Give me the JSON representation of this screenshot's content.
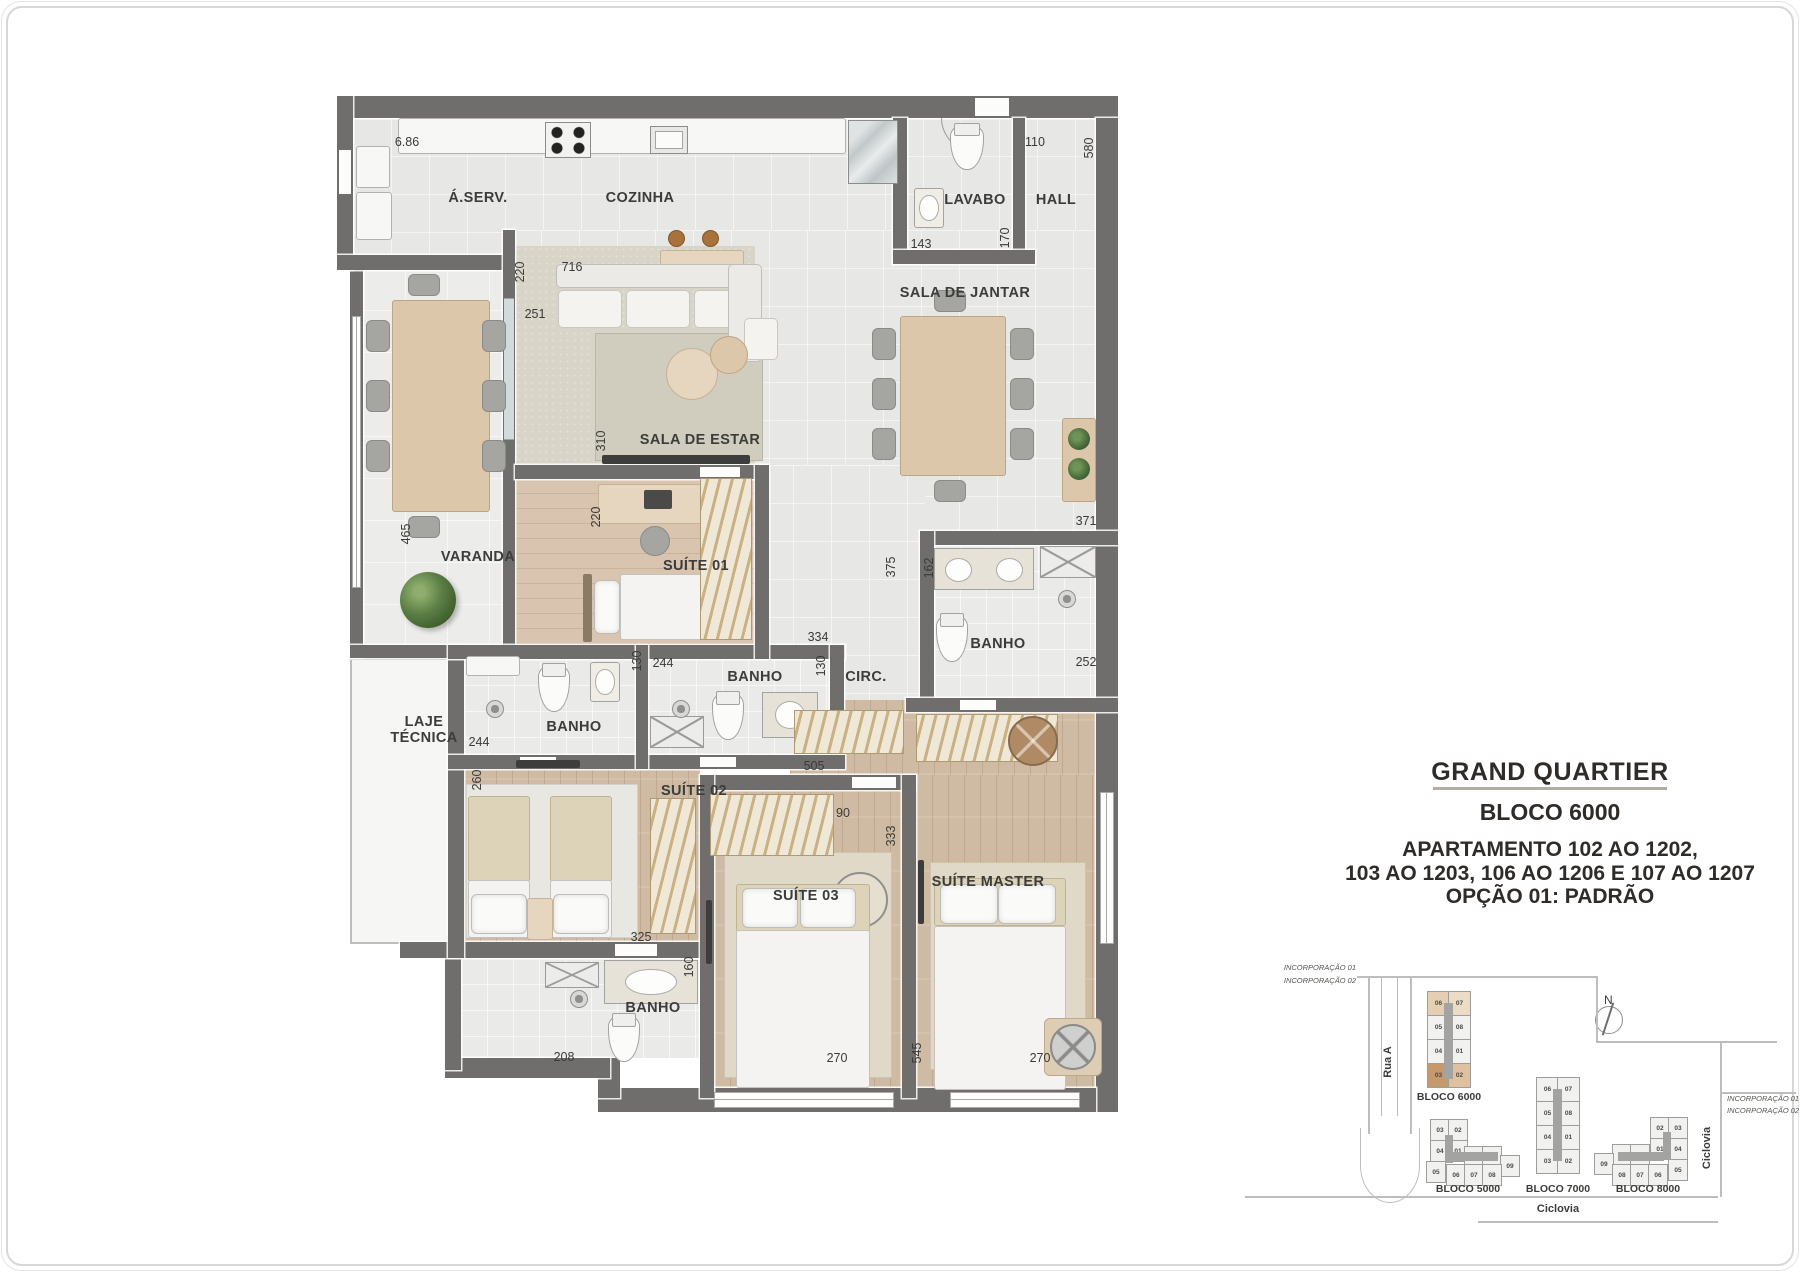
{
  "title_block": {
    "project": "GRAND QUARTIER",
    "block": "BLOCO 6000",
    "apartments_line1": "APARTAMENTO 102 AO 1202,",
    "apartments_line2": "103 AO 1203, 106 AO 1206 E 107 AO 1207",
    "apartments_line3": "OPÇÃO 01: PADRÃO"
  },
  "plan": {
    "room_labels": [
      {
        "id": "aserv",
        "text": "Á.SERV.",
        "x": 478,
        "y": 198
      },
      {
        "id": "cozinha",
        "text": "COZINHA",
        "x": 640,
        "y": 198
      },
      {
        "id": "lavabo",
        "text": "LAVABO",
        "x": 975,
        "y": 200
      },
      {
        "id": "hall",
        "text": "HALL",
        "x": 1056,
        "y": 200
      },
      {
        "id": "sala-de-jantar",
        "text": "SALA DE JANTAR",
        "x": 965,
        "y": 293
      },
      {
        "id": "sala-de-estar",
        "text": "SALA DE ESTAR",
        "x": 700,
        "y": 440
      },
      {
        "id": "varanda",
        "text": "VARANDA",
        "x": 478,
        "y": 557
      },
      {
        "id": "suite-01",
        "text": "SUÍTE 01",
        "x": 696,
        "y": 566
      },
      {
        "id": "laje-tecnica-1",
        "text": "LAJE",
        "x": 424,
        "y": 722
      },
      {
        "id": "laje-tecnica-2",
        "text": "TÉCNICA",
        "x": 424,
        "y": 738
      },
      {
        "id": "banho-suite02",
        "text": "BANHO",
        "x": 574,
        "y": 727
      },
      {
        "id": "banho-suite01",
        "text": "BANHO",
        "x": 755,
        "y": 677
      },
      {
        "id": "circ",
        "text": "CIRC.",
        "x": 866,
        "y": 677
      },
      {
        "id": "banho-master",
        "text": "BANHO",
        "x": 998,
        "y": 644
      },
      {
        "id": "suite-02",
        "text": "SUÍTE 02",
        "x": 694,
        "y": 791
      },
      {
        "id": "banho-inferior",
        "text": "BANHO",
        "x": 653,
        "y": 1008
      },
      {
        "id": "suite-03",
        "text": "SUÍTE 03",
        "x": 806,
        "y": 896
      },
      {
        "id": "suite-master",
        "text": "SUÍTE MASTER",
        "x": 988,
        "y": 882
      }
    ],
    "dimensions": [
      {
        "text": "6.86",
        "x": 407,
        "y": 142,
        "v": false
      },
      {
        "text": "220",
        "x": 520,
        "y": 272,
        "v": true
      },
      {
        "text": "716",
        "x": 572,
        "y": 267,
        "v": false
      },
      {
        "text": "251",
        "x": 535,
        "y": 314,
        "v": false
      },
      {
        "text": "110",
        "x": 1035,
        "y": 142,
        "v": false
      },
      {
        "text": "580",
        "x": 1089,
        "y": 148,
        "v": true
      },
      {
        "text": "143",
        "x": 921,
        "y": 244,
        "v": false
      },
      {
        "text": "170",
        "x": 1005,
        "y": 238,
        "v": true
      },
      {
        "text": "310",
        "x": 601,
        "y": 441,
        "v": true
      },
      {
        "text": "220",
        "x": 596,
        "y": 517,
        "v": true
      },
      {
        "text": "465",
        "x": 406,
        "y": 534,
        "v": true
      },
      {
        "text": "334",
        "x": 818,
        "y": 637,
        "v": false
      },
      {
        "text": "375",
        "x": 891,
        "y": 567,
        "v": true
      },
      {
        "text": "162",
        "x": 929,
        "y": 568,
        "v": true
      },
      {
        "text": "371",
        "x": 1086,
        "y": 521,
        "v": false
      },
      {
        "text": "252",
        "x": 1086,
        "y": 662,
        "v": false
      },
      {
        "text": "244",
        "x": 663,
        "y": 663,
        "v": false
      },
      {
        "text": "130",
        "x": 821,
        "y": 666,
        "v": true
      },
      {
        "text": "244",
        "x": 479,
        "y": 742,
        "v": false
      },
      {
        "text": "130",
        "x": 637,
        "y": 661,
        "v": true
      },
      {
        "text": "505",
        "x": 814,
        "y": 766,
        "v": false
      },
      {
        "text": "90",
        "x": 843,
        "y": 813,
        "v": false
      },
      {
        "text": "260",
        "x": 477,
        "y": 780,
        "v": true
      },
      {
        "text": "325",
        "x": 641,
        "y": 937,
        "v": false
      },
      {
        "text": "160",
        "x": 689,
        "y": 967,
        "v": true
      },
      {
        "text": "208",
        "x": 564,
        "y": 1057,
        "v": false
      },
      {
        "text": "333",
        "x": 891,
        "y": 836,
        "v": true
      },
      {
        "text": "270",
        "x": 837,
        "y": 1058,
        "v": false
      },
      {
        "text": "545",
        "x": 917,
        "y": 1053,
        "v": true
      },
      {
        "text": "270",
        "x": 1040,
        "y": 1058,
        "v": false
      }
    ]
  },
  "sitemap": {
    "north_label": "N",
    "streets": {
      "rua_a": "Rua A",
      "ciclovia_bottom": "Ciclovia",
      "ciclovia_right": "Ciclovia"
    },
    "incorporation_left": [
      "INCORPORAÇÃO 01",
      "INCORPORAÇÃO 02"
    ],
    "incorporation_right": [
      "INCORPORAÇÃO 01",
      "INCORPORAÇÃO 02"
    ],
    "buildings": [
      {
        "id": "bloco-6000",
        "label": "BLOCO 6000",
        "lx": 1449,
        "ly": 1097,
        "cw": 21,
        "ch": 23,
        "units": [
          {
            "n": "06",
            "x": 1427,
            "y": 991,
            "c": "#e5cfb3"
          },
          {
            "n": "07",
            "x": 1448,
            "y": 991,
            "c": "#ecdcc6"
          },
          {
            "n": "05",
            "x": 1427,
            "y": 1015
          },
          {
            "n": "08",
            "x": 1448,
            "y": 1015
          },
          {
            "n": "04",
            "x": 1427,
            "y": 1039
          },
          {
            "n": "01",
            "x": 1448,
            "y": 1039
          },
          {
            "n": "03",
            "x": 1427,
            "y": 1063,
            "c": "#c6996d"
          },
          {
            "n": "02",
            "x": 1448,
            "y": 1063,
            "c": "#dfc19f"
          }
        ]
      },
      {
        "id": "bloco-7000",
        "label": "BLOCO 7000",
        "lx": 1558,
        "ly": 1189,
        "cw": 21,
        "ch": 23,
        "units": [
          {
            "n": "06",
            "x": 1536,
            "y": 1077
          },
          {
            "n": "07",
            "x": 1557,
            "y": 1077
          },
          {
            "n": "05",
            "x": 1536,
            "y": 1101
          },
          {
            "n": "08",
            "x": 1557,
            "y": 1101
          },
          {
            "n": "04",
            "x": 1536,
            "y": 1125
          },
          {
            "n": "01",
            "x": 1557,
            "y": 1125
          },
          {
            "n": "03",
            "x": 1536,
            "y": 1149
          },
          {
            "n": "02",
            "x": 1557,
            "y": 1149
          }
        ]
      },
      {
        "id": "bloco-5000",
        "label": "BLOCO 5000",
        "lx": 1468,
        "ly": 1189,
        "cw": 18,
        "ch": 20,
        "units": [
          {
            "n": "03",
            "x": 1430,
            "y": 1119
          },
          {
            "n": "02",
            "x": 1448,
            "y": 1119
          },
          {
            "n": "04",
            "x": 1430,
            "y": 1140
          },
          {
            "n": "01",
            "x": 1448,
            "y": 1140
          },
          {
            "n": "05",
            "x": 1426,
            "y": 1161
          },
          {
            "n": "11",
            "x": 1464,
            "y": 1146
          },
          {
            "n": "10",
            "x": 1482,
            "y": 1146
          },
          {
            "n": "09",
            "x": 1500,
            "y": 1155
          },
          {
            "n": "06",
            "x": 1446,
            "y": 1164
          },
          {
            "n": "07",
            "x": 1464,
            "y": 1164
          },
          {
            "n": "08",
            "x": 1482,
            "y": 1164
          }
        ]
      },
      {
        "id": "bloco-8000",
        "label": "BLOCO 8000",
        "lx": 1648,
        "ly": 1189,
        "cw": 18,
        "ch": 20,
        "units": [
          {
            "n": "02",
            "x": 1650,
            "y": 1117
          },
          {
            "n": "03",
            "x": 1668,
            "y": 1117
          },
          {
            "n": "01",
            "x": 1650,
            "y": 1138
          },
          {
            "n": "04",
            "x": 1668,
            "y": 1138
          },
          {
            "n": "05",
            "x": 1668,
            "y": 1159
          },
          {
            "n": "10",
            "x": 1612,
            "y": 1144
          },
          {
            "n": "11",
            "x": 1630,
            "y": 1144
          },
          {
            "n": "09",
            "x": 1594,
            "y": 1153
          },
          {
            "n": "08",
            "x": 1612,
            "y": 1164
          },
          {
            "n": "07",
            "x": 1630,
            "y": 1164
          },
          {
            "n": "06",
            "x": 1648,
            "y": 1164
          }
        ]
      }
    ]
  },
  "colors": {
    "wall": "#6f6e6c",
    "tile_floor": "#e7e7e5",
    "wood_floor": "#cfbba3",
    "carpet": "#d8d5c8",
    "highlight_unit_dark": "#c6996d",
    "highlight_unit_light": "#e5cfb3",
    "text": "#3c3c3a"
  }
}
